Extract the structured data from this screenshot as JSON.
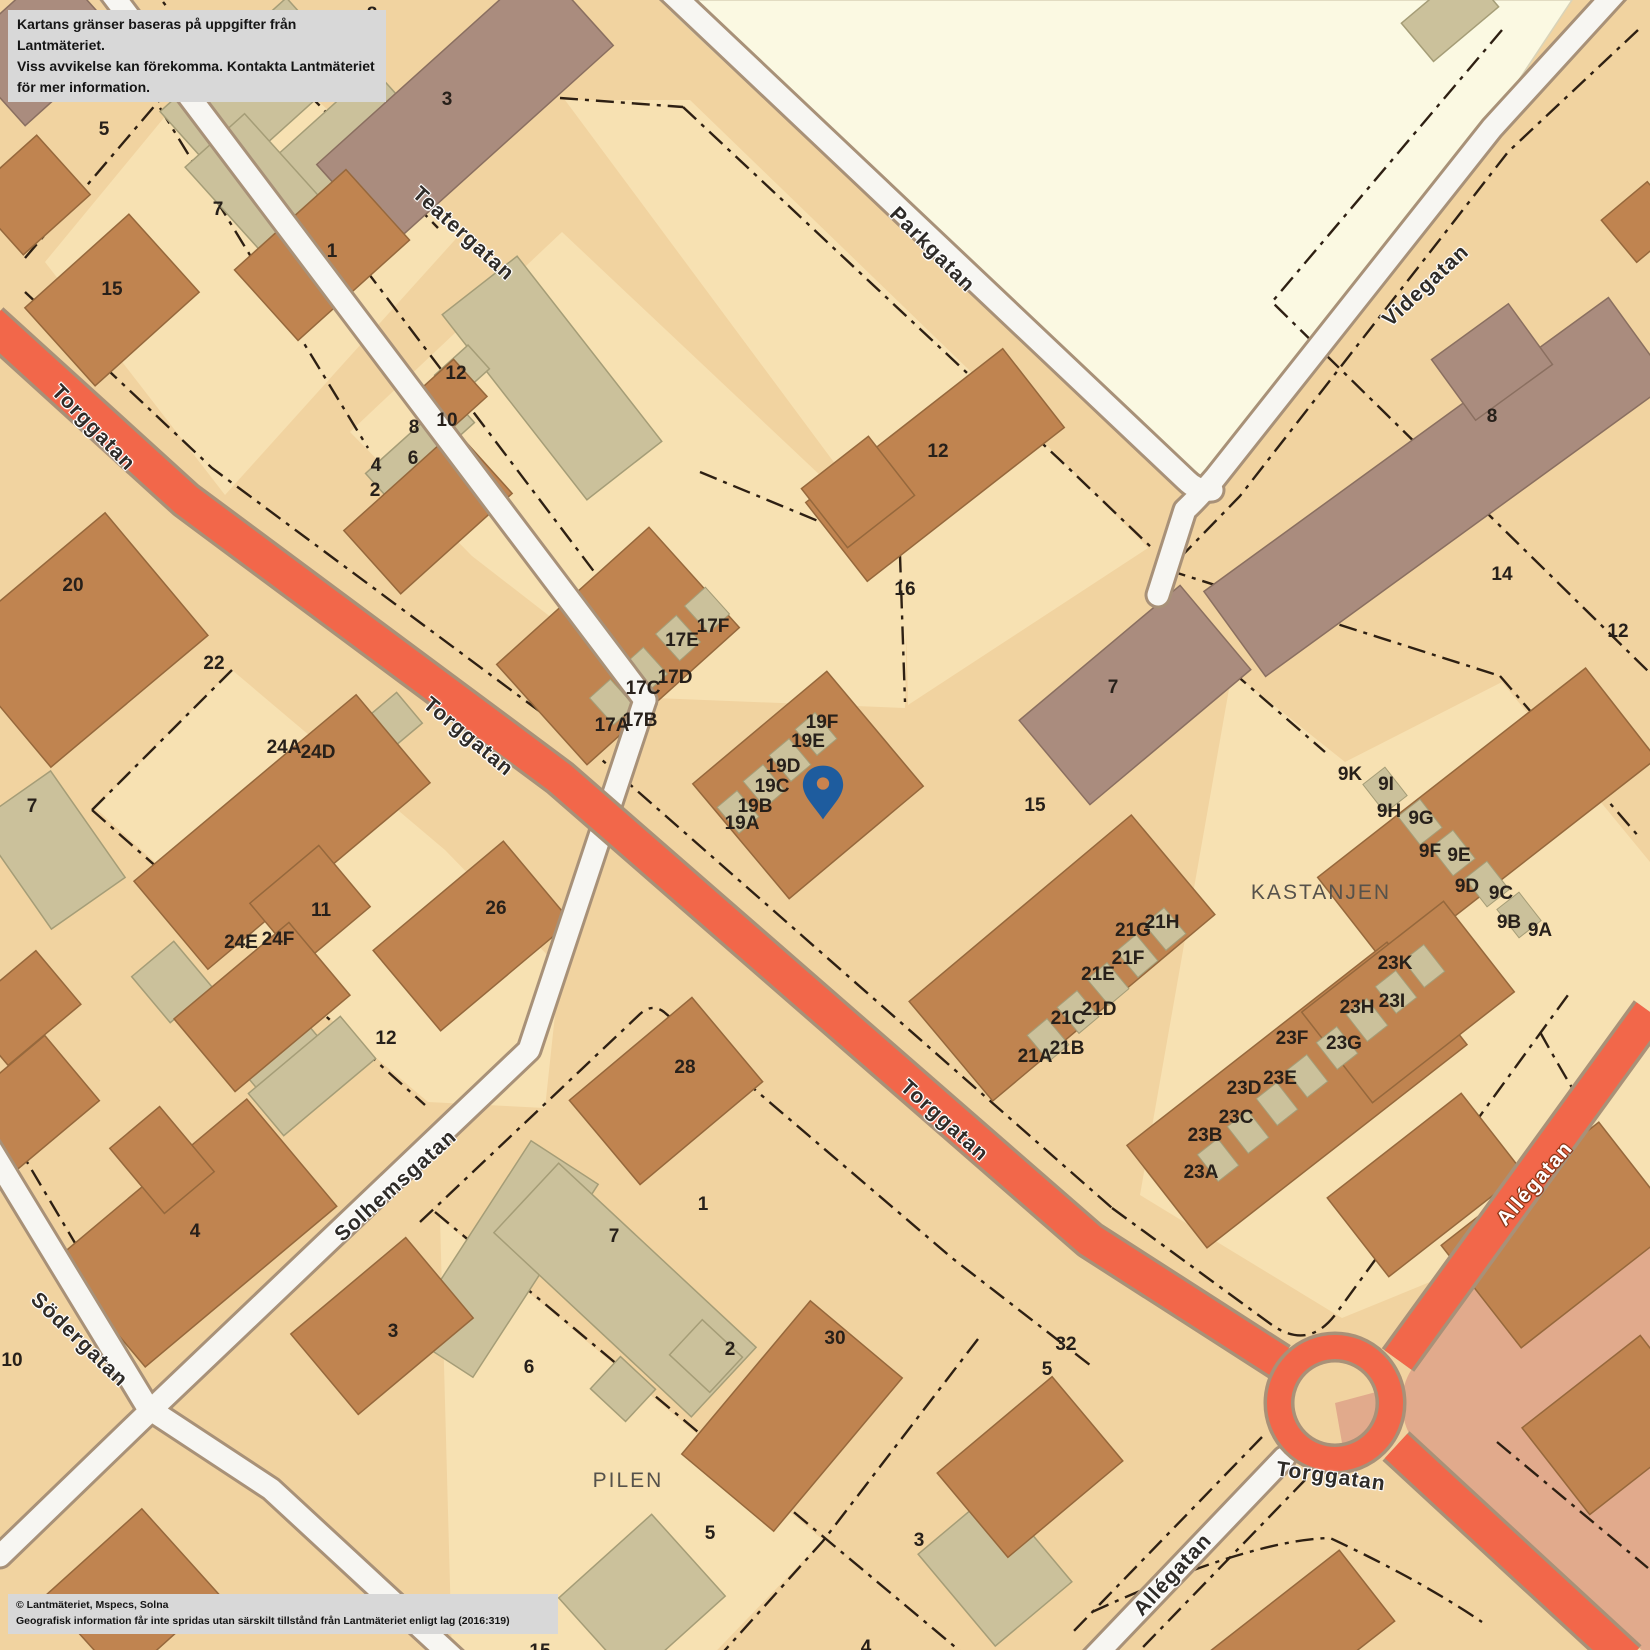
{
  "disclaimer": {
    "line1": "Kartans gränser baseras på uppgifter från Lantmäteriet.",
    "line2": "Viss avvikelse kan förekomma. Kontakta Lantmäteriet för mer information."
  },
  "attribution": {
    "line1": "© Lantmäteriet, Mspecs, Solna",
    "line2": "Geografisk information får inte spridas utan särskilt tillstånd från Lantmäteriet enligt lag (2016:319)"
  },
  "marker": {
    "icon": "map-pin",
    "x": 823,
    "y": 788
  },
  "area_labels": [
    {
      "text": "DUVAN",
      "x": 78,
      "y": 71
    },
    {
      "text": "KASTANJEN",
      "x": 1321,
      "y": 893
    },
    {
      "text": "PILEN",
      "x": 628,
      "y": 1481
    }
  ],
  "street_labels": [
    {
      "text": "Torggatan",
      "x": 93,
      "y": 428,
      "rot": 46,
      "orange": false
    },
    {
      "text": "Torggatan",
      "x": 468,
      "y": 737,
      "rot": 40,
      "orange": false
    },
    {
      "text": "Torggatan",
      "x": 944,
      "y": 1121,
      "rot": 42,
      "orange": false
    },
    {
      "text": "Torggatan",
      "x": 1331,
      "y": 1477,
      "rot": 8,
      "orange": false
    },
    {
      "text": "Teatergatan",
      "x": 463,
      "y": 234,
      "rot": 42,
      "orange": false
    },
    {
      "text": "Parkgatan",
      "x": 932,
      "y": 250,
      "rot": 45,
      "orange": false
    },
    {
      "text": "Videgatan",
      "x": 1426,
      "y": 286,
      "rot": -43,
      "orange": false
    },
    {
      "text": "Solhemsgatan",
      "x": 396,
      "y": 1186,
      "rot": -42,
      "orange": false
    },
    {
      "text": "Södergatan",
      "x": 79,
      "y": 1340,
      "rot": 44,
      "orange": false
    },
    {
      "text": "Allégatan",
      "x": 1535,
      "y": 1184,
      "rot": -49,
      "orange": true
    },
    {
      "text": "Allégatan",
      "x": 1173,
      "y": 1575,
      "rot": -47,
      "orange": false
    }
  ],
  "house_numbers": [
    {
      "t": "8",
      "x": 372,
      "y": 15
    },
    {
      "t": "5",
      "x": 104,
      "y": 130
    },
    {
      "t": "7",
      "x": 218,
      "y": 210
    },
    {
      "t": "3",
      "x": 447,
      "y": 100
    },
    {
      "t": "1",
      "x": 332,
      "y": 252
    },
    {
      "t": "15",
      "x": 112,
      "y": 290
    },
    {
      "t": "12",
      "x": 456,
      "y": 374
    },
    {
      "t": "10",
      "x": 447,
      "y": 421
    },
    {
      "t": "8",
      "x": 414,
      "y": 428
    },
    {
      "t": "6",
      "x": 413,
      "y": 459
    },
    {
      "t": "4",
      "x": 376,
      "y": 466
    },
    {
      "t": "2",
      "x": 375,
      "y": 491
    },
    {
      "t": "17A",
      "x": 612,
      "y": 726
    },
    {
      "t": "17B",
      "x": 640,
      "y": 721
    },
    {
      "t": "17C",
      "x": 643,
      "y": 689
    },
    {
      "t": "17D",
      "x": 675,
      "y": 678
    },
    {
      "t": "17E",
      "x": 682,
      "y": 641
    },
    {
      "t": "17F",
      "x": 713,
      "y": 627
    },
    {
      "t": "19A",
      "x": 742,
      "y": 824
    },
    {
      "t": "19B",
      "x": 755,
      "y": 807
    },
    {
      "t": "19C",
      "x": 772,
      "y": 787
    },
    {
      "t": "19D",
      "x": 783,
      "y": 767
    },
    {
      "t": "19E",
      "x": 808,
      "y": 742
    },
    {
      "t": "19F",
      "x": 822,
      "y": 723
    },
    {
      "t": "16",
      "x": 905,
      "y": 590
    },
    {
      "t": "12",
      "x": 938,
      "y": 452
    },
    {
      "t": "7",
      "x": 1113,
      "y": 688
    },
    {
      "t": "15",
      "x": 1035,
      "y": 806
    },
    {
      "t": "8",
      "x": 1492,
      "y": 417
    },
    {
      "t": "14",
      "x": 1502,
      "y": 575
    },
    {
      "t": "12",
      "x": 1618,
      "y": 632
    },
    {
      "t": "9K",
      "x": 1350,
      "y": 775
    },
    {
      "t": "9I",
      "x": 1386,
      "y": 785
    },
    {
      "t": "9H",
      "x": 1389,
      "y": 812
    },
    {
      "t": "9G",
      "x": 1421,
      "y": 819
    },
    {
      "t": "9F",
      "x": 1430,
      "y": 852
    },
    {
      "t": "9E",
      "x": 1459,
      "y": 856
    },
    {
      "t": "9D",
      "x": 1467,
      "y": 887
    },
    {
      "t": "9C",
      "x": 1501,
      "y": 894
    },
    {
      "t": "9B",
      "x": 1509,
      "y": 923
    },
    {
      "t": "9A",
      "x": 1540,
      "y": 931
    },
    {
      "t": "21A",
      "x": 1035,
      "y": 1057
    },
    {
      "t": "21B",
      "x": 1067,
      "y": 1049
    },
    {
      "t": "21C",
      "x": 1068,
      "y": 1019
    },
    {
      "t": "21D",
      "x": 1099,
      "y": 1010
    },
    {
      "t": "21E",
      "x": 1098,
      "y": 975
    },
    {
      "t": "21F",
      "x": 1128,
      "y": 959
    },
    {
      "t": "21G",
      "x": 1133,
      "y": 931
    },
    {
      "t": "21H",
      "x": 1162,
      "y": 923
    },
    {
      "t": "23A",
      "x": 1201,
      "y": 1173
    },
    {
      "t": "23B",
      "x": 1205,
      "y": 1136
    },
    {
      "t": "23C",
      "x": 1236,
      "y": 1118
    },
    {
      "t": "23D",
      "x": 1244,
      "y": 1089
    },
    {
      "t": "23E",
      "x": 1280,
      "y": 1079
    },
    {
      "t": "23F",
      "x": 1292,
      "y": 1039
    },
    {
      "t": "23G",
      "x": 1344,
      "y": 1044
    },
    {
      "t": "23H",
      "x": 1357,
      "y": 1008
    },
    {
      "t": "23I",
      "x": 1392,
      "y": 1002
    },
    {
      "t": "23K",
      "x": 1395,
      "y": 964
    },
    {
      "t": "24A",
      "x": 284,
      "y": 748
    },
    {
      "t": "24D",
      "x": 318,
      "y": 753
    },
    {
      "t": "24E",
      "x": 241,
      "y": 943
    },
    {
      "t": "24F",
      "x": 278,
      "y": 940
    },
    {
      "t": "11",
      "x": 321,
      "y": 911
    },
    {
      "t": "26",
      "x": 496,
      "y": 909
    },
    {
      "t": "12",
      "x": 386,
      "y": 1039
    },
    {
      "t": "22",
      "x": 214,
      "y": 664
    },
    {
      "t": "20",
      "x": 73,
      "y": 586
    },
    {
      "t": "7",
      "x": 32,
      "y": 807
    },
    {
      "t": "4",
      "x": 195,
      "y": 1232
    },
    {
      "t": "10",
      "x": 12,
      "y": 1361
    },
    {
      "t": "3",
      "x": 393,
      "y": 1332
    },
    {
      "t": "6",
      "x": 529,
      "y": 1368
    },
    {
      "t": "28",
      "x": 685,
      "y": 1068
    },
    {
      "t": "1",
      "x": 703,
      "y": 1205
    },
    {
      "t": "7",
      "x": 614,
      "y": 1237
    },
    {
      "t": "2",
      "x": 730,
      "y": 1350
    },
    {
      "t": "30",
      "x": 835,
      "y": 1339
    },
    {
      "t": "5",
      "x": 710,
      "y": 1534
    },
    {
      "t": "3",
      "x": 919,
      "y": 1541
    },
    {
      "t": "32",
      "x": 1066,
      "y": 1345
    },
    {
      "t": "5",
      "x": 1047,
      "y": 1370
    },
    {
      "t": "4",
      "x": 866,
      "y": 1648
    },
    {
      "t": "15",
      "x": 540,
      "y": 1652
    }
  ],
  "colors": {
    "background": "#f1d3a0",
    "parcel": "#f7e1b2",
    "park": "#fbf9e2",
    "road_white": "#f7f6f2",
    "road_orange": "#f2674a",
    "road_casing": "#a89178",
    "building_brown": "#c08450",
    "building_mauve": "#aa8c7e",
    "building_khaki": "#cbc19b",
    "pink_zone": "#e1aa8c",
    "marker_blue": "#1e5c9e",
    "boundary": "#2e2013"
  }
}
